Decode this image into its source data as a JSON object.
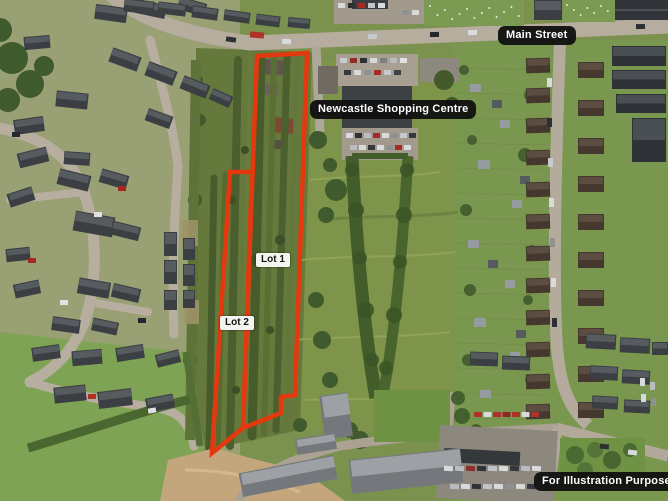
{
  "labels": {
    "main_street": "Main Street",
    "shopping_centre": "Newcastle Shopping Centre",
    "disclaimer": "For Illustration Purposes"
  },
  "lots": [
    {
      "name": "Lot 1",
      "outline": "257,56 307,53 295,395 281,397 281,413 243,428"
    },
    {
      "name": "Lot 2",
      "outline": "230,172 252,172 243,428 212,453"
    }
  ],
  "colors": {
    "boundary_red": "#e4390f",
    "label_dark_bg": "#101010",
    "label_dark_text": "#ffffff",
    "label_light_bg": "#f3f3ef",
    "label_light_text": "#141414"
  }
}
